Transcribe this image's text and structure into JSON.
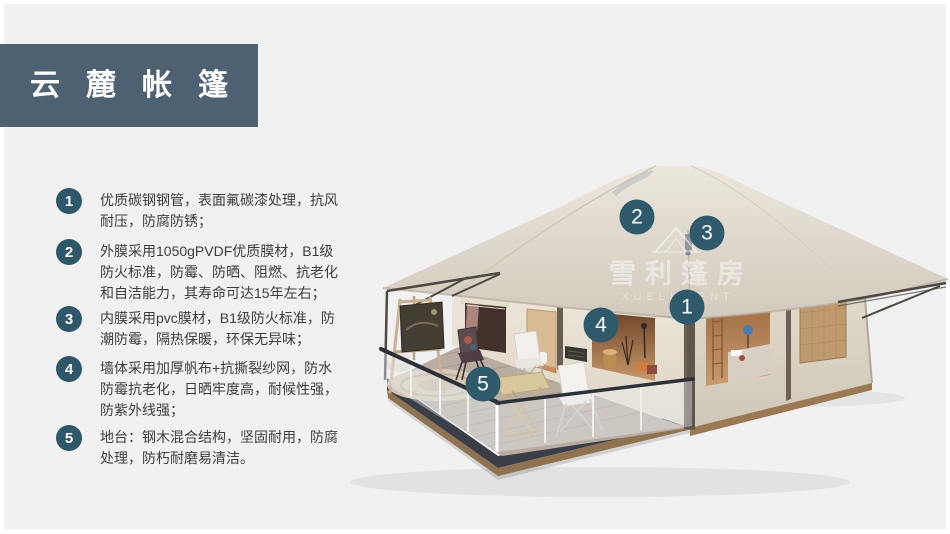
{
  "header": {
    "title": "云麓帐篷"
  },
  "features": [
    {
      "num": "1",
      "text": "优质碳钢钢管，表面氟碳漆处理，抗风耐压，防腐防锈；"
    },
    {
      "num": "2",
      "text": "外膜采用1050gPVDF优质膜材，B1级防火标准，防霉、防晒、阻燃、抗老化和自洁能力，其寿命可达15年左右；"
    },
    {
      "num": "3",
      "text": "内膜采用pvc膜材，B1级防火标准，防潮防霉，隔热保暖，环保无异味；"
    },
    {
      "num": "4",
      "text": "墙体采用加厚帆布+抗撕裂纱网，防水防霉抗老化，日晒牢度高，耐候性强，防紫外线强；"
    },
    {
      "num": "5",
      "text": "地台：钢木混合结构，坚固耐用，防腐处理，防朽耐磨易清洁。"
    }
  ],
  "image_markers": [
    {
      "label": "1"
    },
    {
      "label": "2"
    },
    {
      "label": "3"
    },
    {
      "label": "4"
    },
    {
      "label": "5"
    }
  ],
  "watermark": {
    "cn": "雪利篷房",
    "en": "XUELI TENT"
  },
  "colors": {
    "banner_bg": "#4e6173",
    "badge_teal": "#2e5769",
    "page_bg": "#f1f1f2",
    "body_text": "#3c3d3f",
    "roof_beige": "#ddd6ca",
    "wall_cream": "#e8e2d4"
  }
}
